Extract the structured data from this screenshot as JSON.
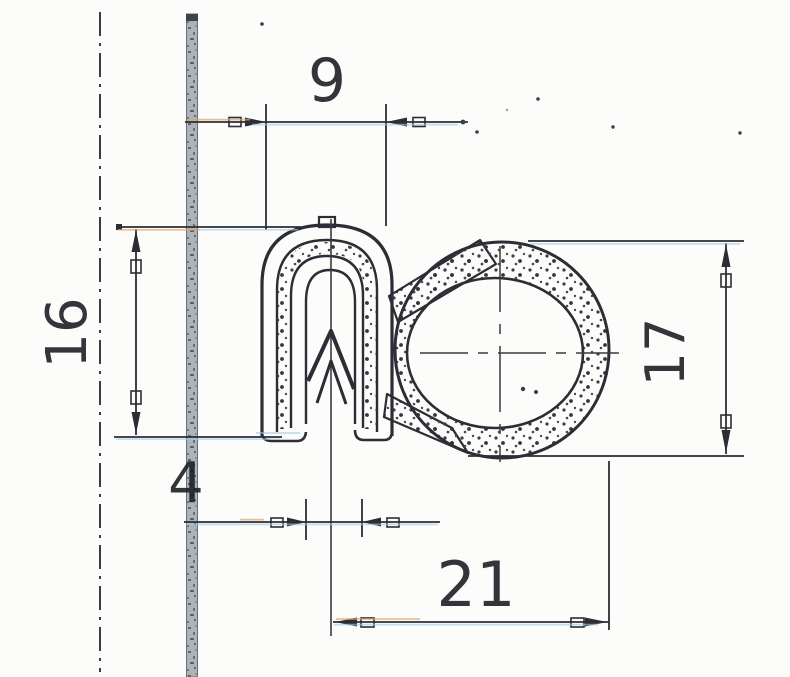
{
  "drawing": {
    "dimension_labels": {
      "clamp_width": "9",
      "clamp_height": "16",
      "bulb_height": "17",
      "overall_width": "21",
      "grip_gap": "4"
    },
    "colors": {
      "ink": "#2c2d35",
      "flange_gray": "#adb3ba",
      "fringe_blue": "#9fc9e4",
      "fringe_tan": "#dba76a",
      "paper": "#fcfcfa"
    }
  }
}
